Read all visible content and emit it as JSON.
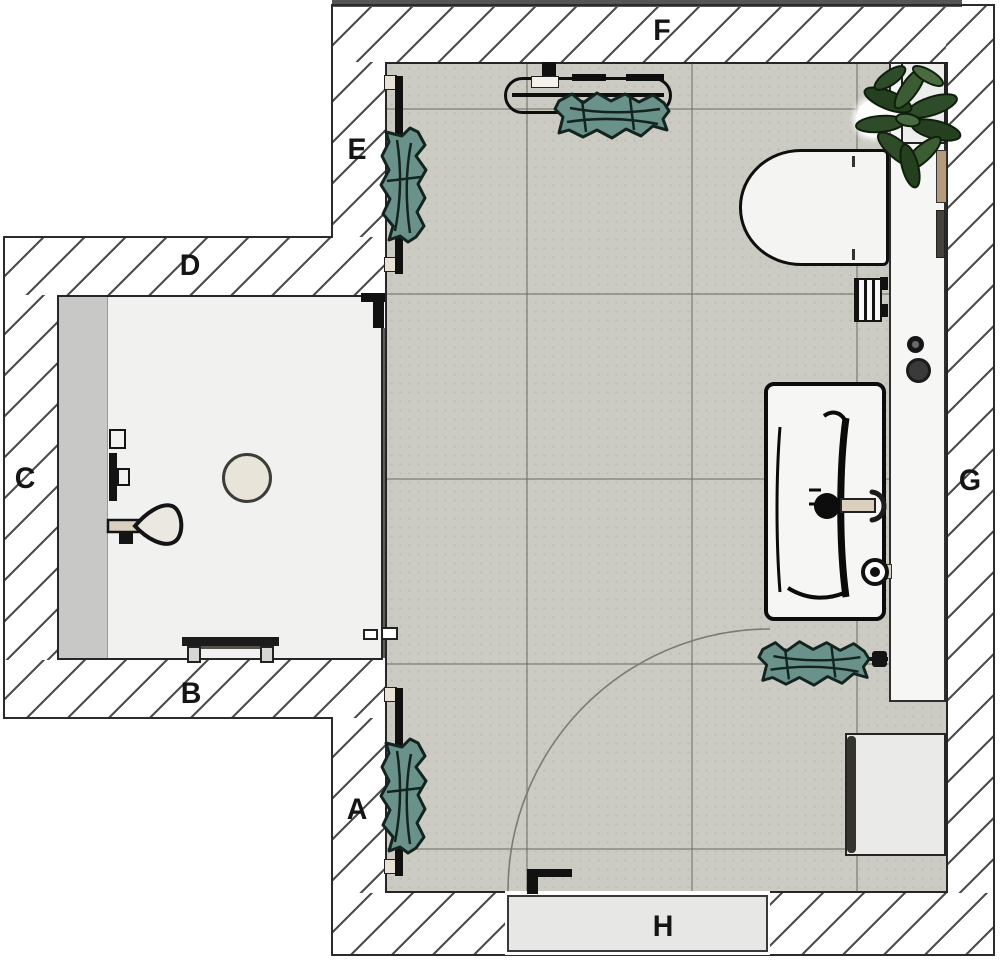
{
  "title": "Bathroom floor plan (top view)",
  "labels": {
    "A": "A",
    "B": "B",
    "C": "C",
    "D": "D",
    "E": "E",
    "F": "F",
    "G": "G",
    "H": "H"
  },
  "fixtures": [
    "toilet",
    "vanity-sink",
    "sink-drain",
    "faucet",
    "wall-valve",
    "wall-knobs",
    "shower-head",
    "shower-rail",
    "shower-control",
    "shower-drain",
    "shower-bench",
    "glass-screen",
    "screen-handles",
    "towel-radiator-horizontal",
    "towel-radiator-vertical-upper",
    "towel-radiator-vertical-lower",
    "towel-rail",
    "towel",
    "plant",
    "planter",
    "counter-ledge",
    "tan-accessory",
    "dark-accessory",
    "striped-accessory",
    "ceiling-light",
    "laundry-box",
    "door-leaf",
    "door-handle",
    "door-swing-arc"
  ],
  "colors": {
    "wall_hatch_line": "#4d4d4d",
    "tile_floor": "#cbcbc4",
    "tile_grout": "#8d8d82",
    "shower_floor": "#f1f1ef",
    "towel": "#6a928b",
    "towel_outline": "#13241f",
    "plant": "#2e4b2a",
    "door_leaf": "#e7e7e5",
    "counter": "#f6f6f4",
    "accent_tan": "#b69a7a",
    "outline": "#141414"
  }
}
